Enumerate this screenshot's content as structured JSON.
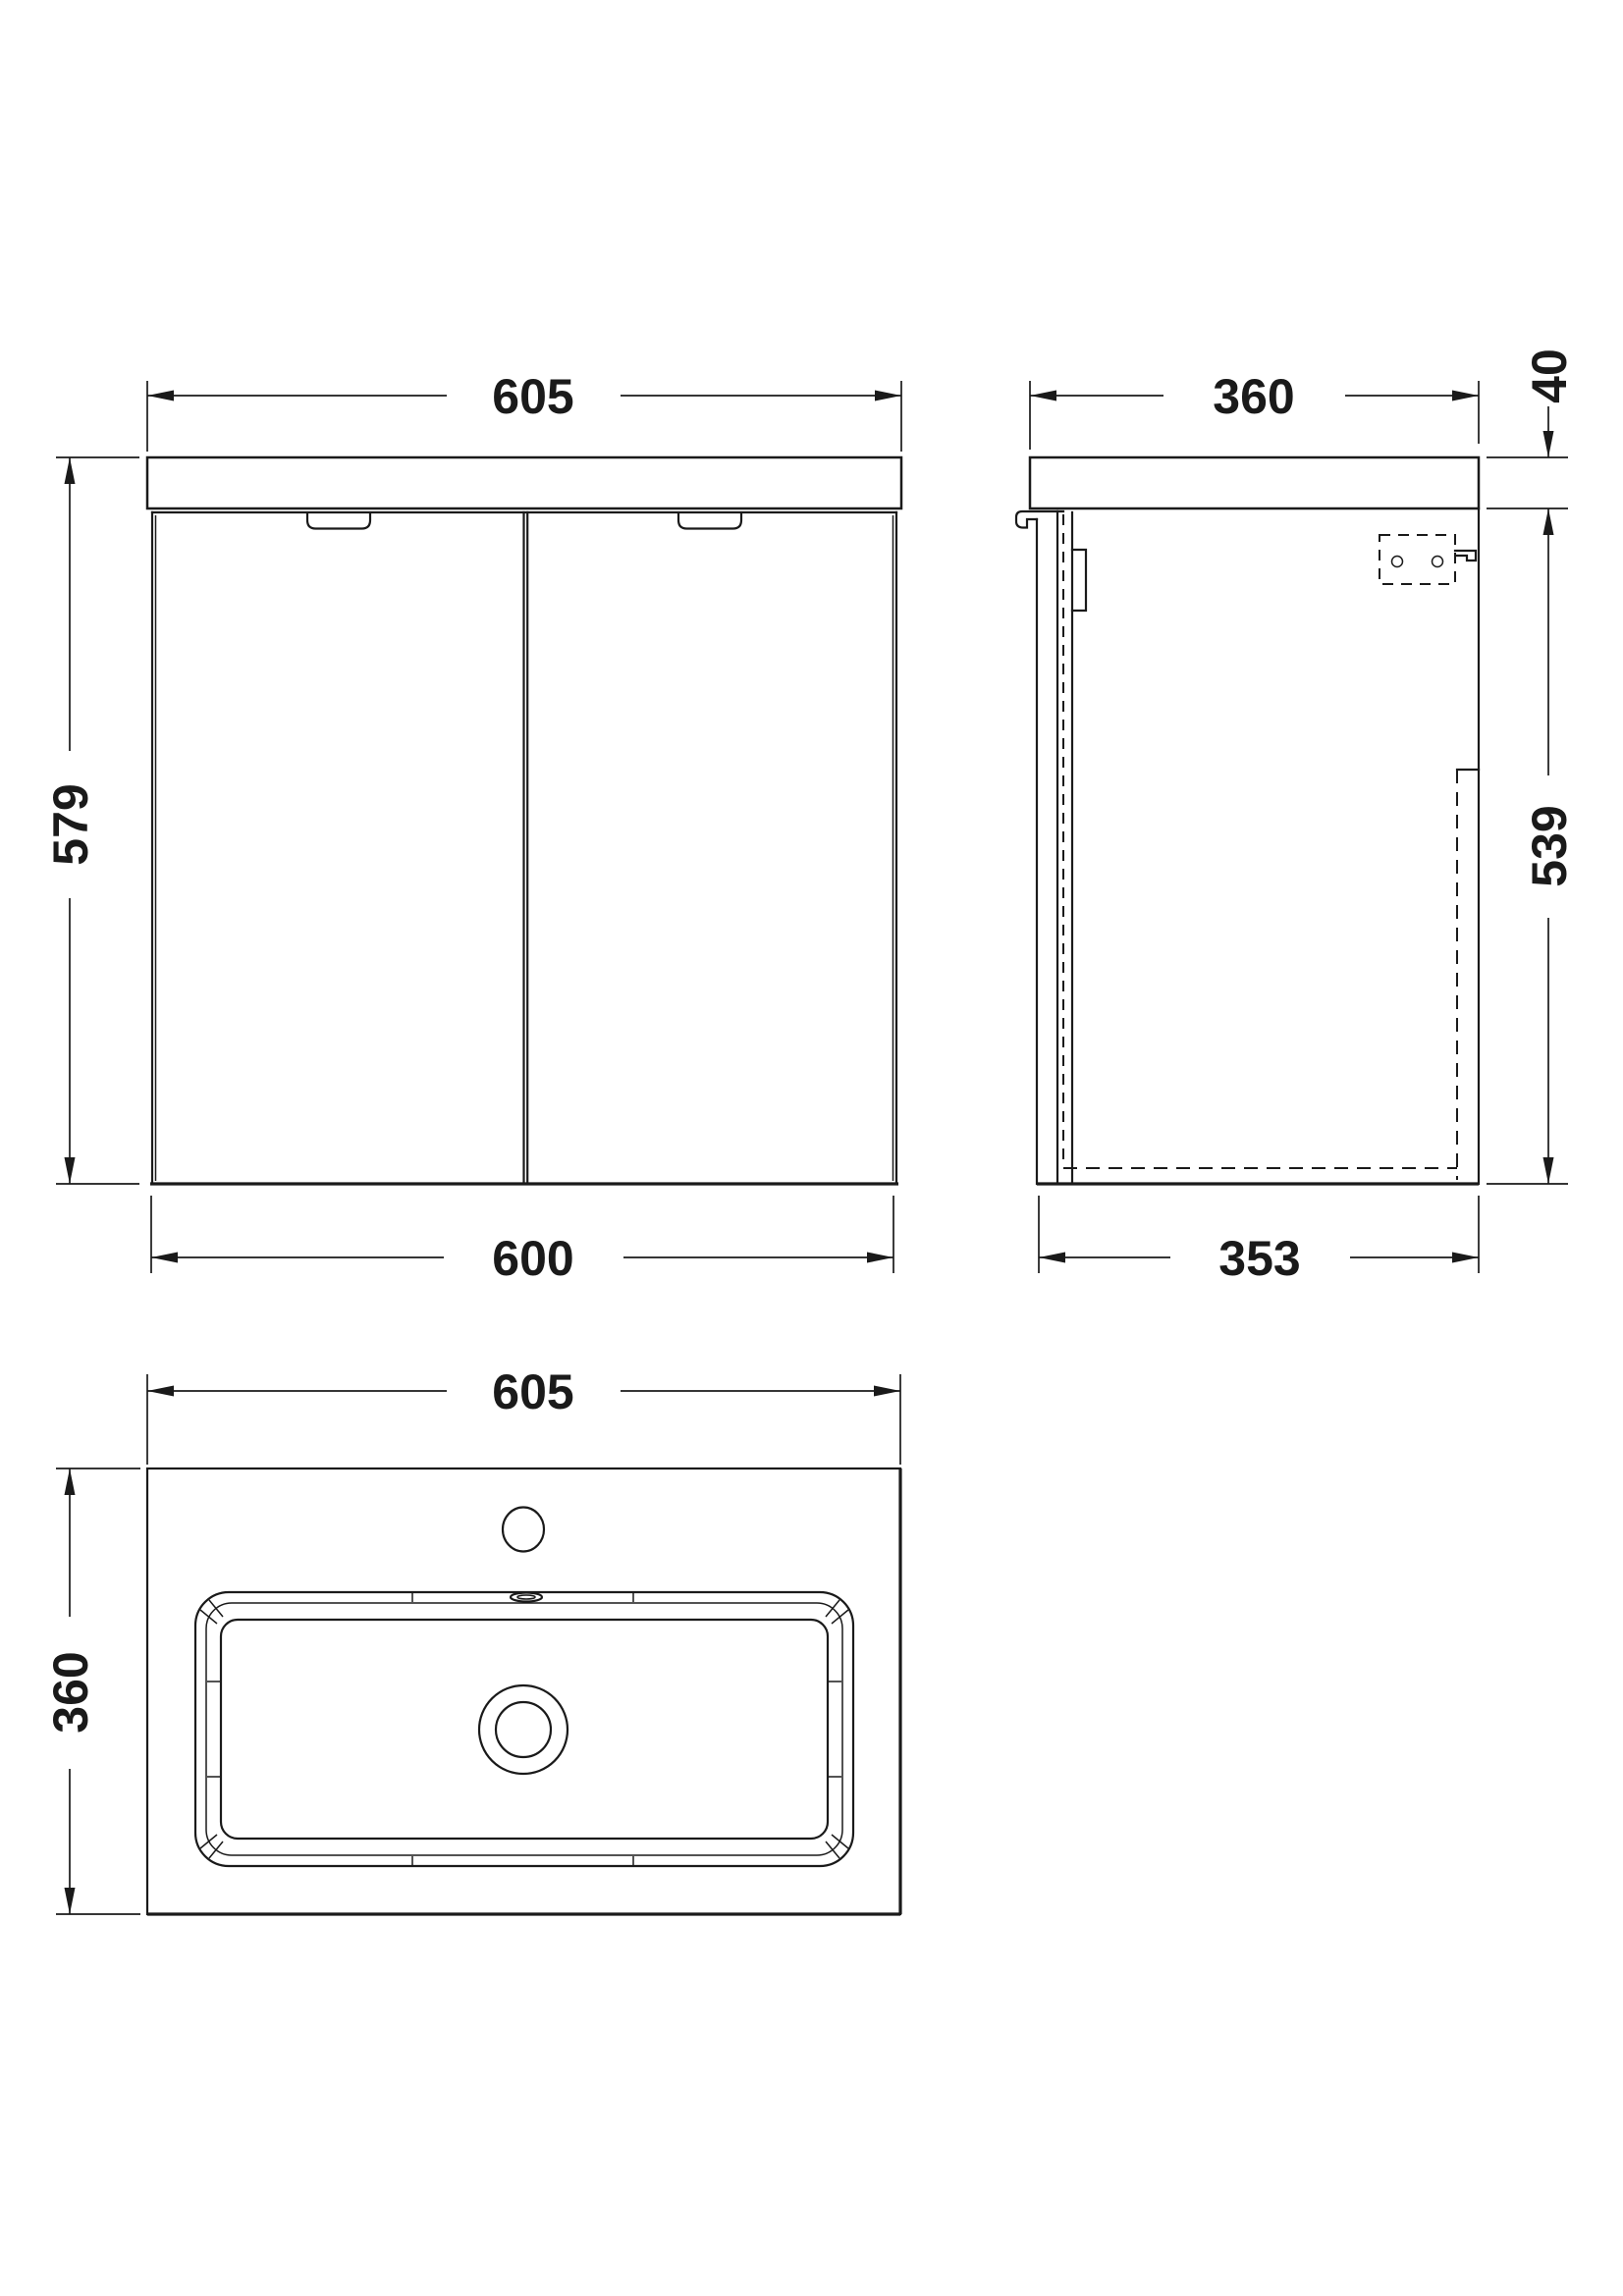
{
  "theme": {
    "background": "#ffffff",
    "line_color": "#1a1a1a"
  },
  "views": {
    "front": {
      "label": "front-elevation",
      "dimensions": {
        "top_width": "605",
        "left_height": "579",
        "bottom_width": "600"
      }
    },
    "side": {
      "label": "side-elevation",
      "dimensions": {
        "top_depth": "360",
        "worktop_thickness": "40",
        "cabinet_height": "539",
        "bottom_depth": "353"
      }
    },
    "plan": {
      "label": "basin-plan",
      "dimensions": {
        "top_width": "605",
        "left_depth": "360"
      }
    }
  }
}
